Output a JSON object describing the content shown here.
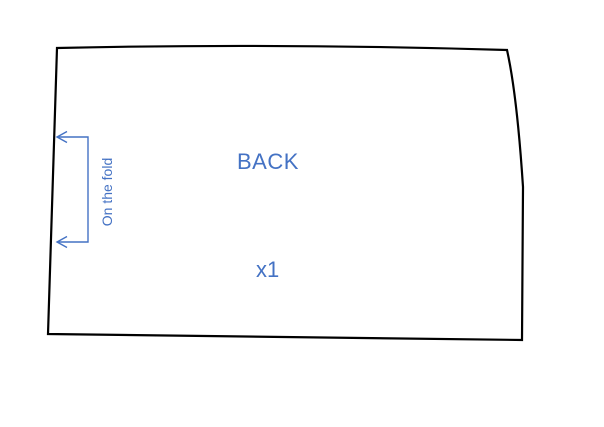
{
  "canvas": {
    "background": "#ffffff",
    "outline_color": "#000000",
    "annotation_color": "#4472C4"
  },
  "pattern_piece": {
    "name": "BACK",
    "quantity": "x1",
    "fold_note": "On the fold"
  }
}
